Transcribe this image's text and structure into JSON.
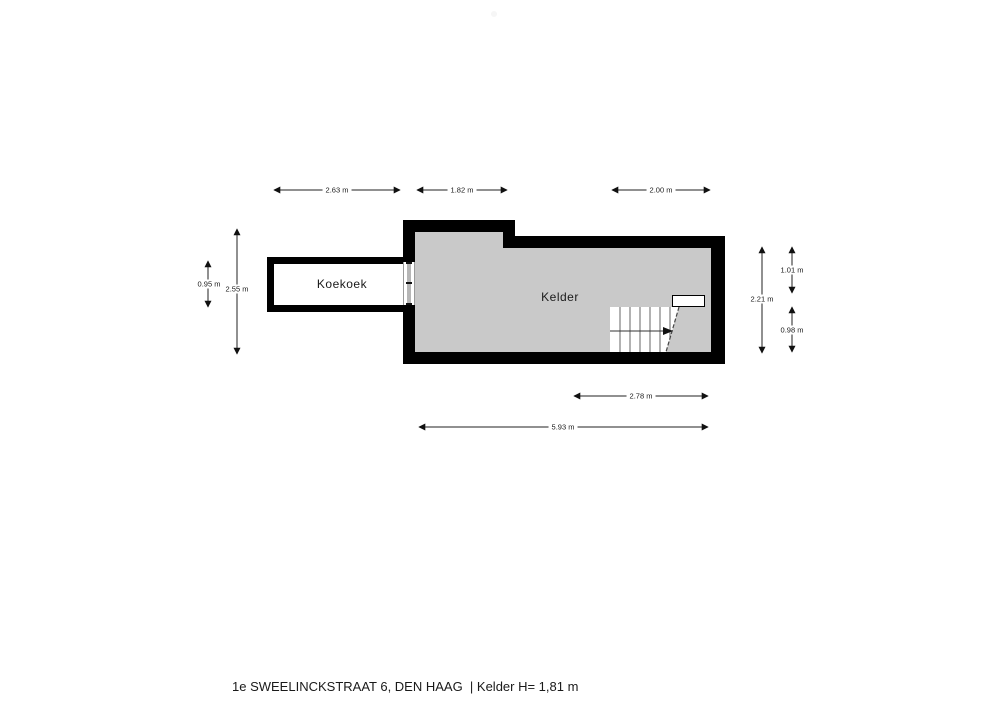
{
  "rooms": {
    "koekoek": "Koekoek",
    "kelder": "Kelder"
  },
  "dimensions": {
    "top_left": "2.63 m",
    "top_mid": "1.82 m",
    "top_right": "2.00 m",
    "bottom_inner": "2.78 m",
    "bottom_outer": "5.93 m",
    "left_inner": "0.95 m",
    "left_outer": "2.55 m",
    "right_outer": "2.21 m",
    "right_top": "1.01 m",
    "right_bottom": "0.98 m"
  },
  "footer": {
    "caption": "1e SWEELINCKSTRAAT 6, DEN HAAG  | Kelder H= 1,81 m"
  },
  "colors": {
    "wall": "#000000",
    "floor": "#c9c9c9",
    "room-floor": "#ffffff",
    "line": "#222222",
    "text": "#1a1a1a"
  }
}
